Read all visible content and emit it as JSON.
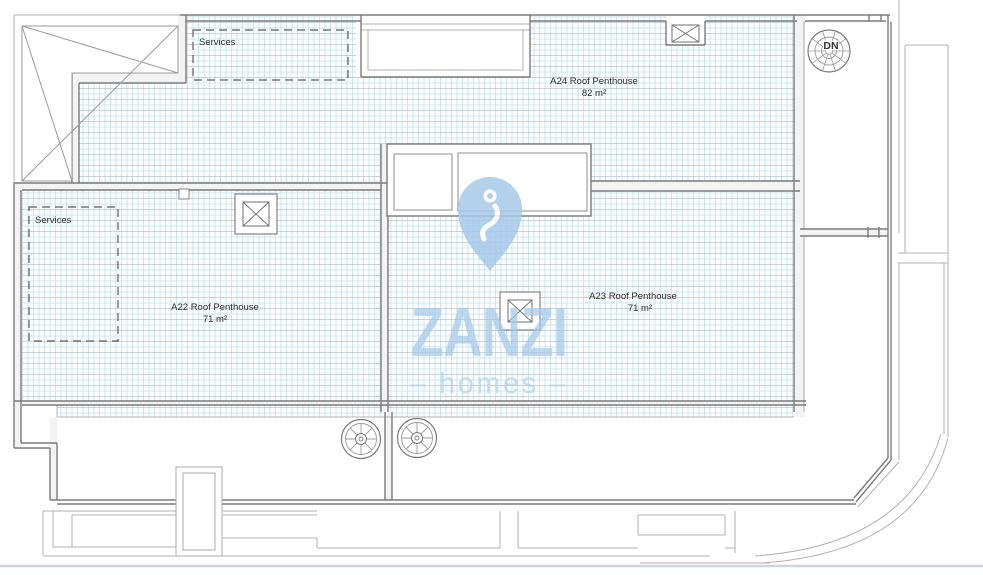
{
  "watermark": {
    "brand": "ZANZI",
    "tagline_display": "– homes –"
  },
  "labels": {
    "services_top": "Services",
    "services_a22": "Services",
    "stair_down": "DN",
    "units": [
      {
        "name": "A24 Roof Penthouse",
        "area": "82 m²"
      },
      {
        "name": "A22 Roof Penthouse",
        "area": "71 m²"
      },
      {
        "name": "A23 Roof Penthouse",
        "area": "71 m²"
      }
    ]
  },
  "colors": {
    "watermark_blue": "#a6c9e8",
    "watermark_light_blue": "#b9d4ec",
    "hatch_blue": "#cbe2ec",
    "hatch_blue2": "#cde5ee",
    "hatch_gray": "#c4ced4",
    "wall_dark": "#7b7b7b",
    "outline_light": "#b2b2b2"
  }
}
